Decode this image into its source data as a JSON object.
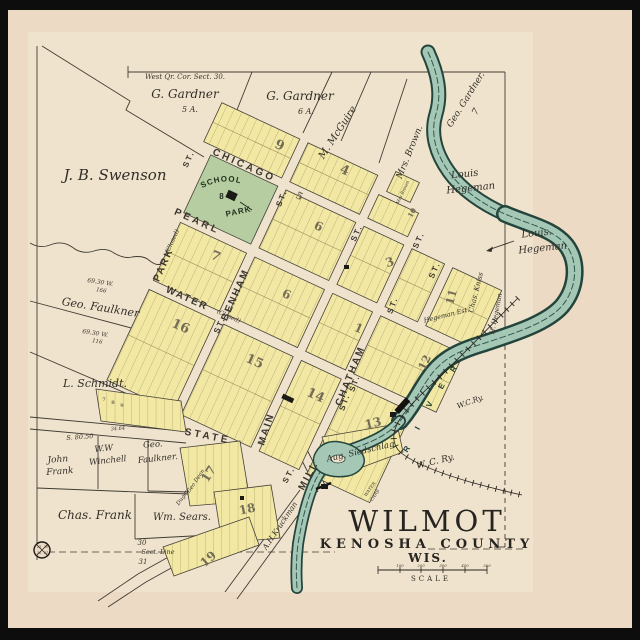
{
  "map_title": {
    "city": "WILMOT",
    "county": "KENOSHA  COUNTY",
    "state": "WIS.",
    "scale_label": "SCALE"
  },
  "park": {
    "line1": "PUBLIC SCHOOL",
    "line2": "PARK",
    "block_no": "8"
  },
  "streets": [
    {
      "t": "CHICAGO",
      "x": 243,
      "y": 168,
      "r": 24,
      "s": 10,
      "ls": 3
    },
    {
      "t": "PEARL",
      "x": 196,
      "y": 224,
      "r": 24,
      "s": 10,
      "ls": 3
    },
    {
      "t": "WATER",
      "x": 186,
      "y": 301,
      "r": 24,
      "s": 10,
      "ls": 2
    },
    {
      "t": "PARK",
      "x": 166,
      "y": 266,
      "r": -66,
      "s": 10,
      "ls": 2
    },
    {
      "t": "BENHAM",
      "x": 238,
      "y": 296,
      "r": -66,
      "s": 10,
      "ls": 2
    },
    {
      "t": "MAIN",
      "x": 269,
      "y": 430,
      "r": -72,
      "s": 10,
      "ls": 2
    },
    {
      "t": "CHATHAM",
      "x": 353,
      "y": 377,
      "r": -68,
      "s": 10,
      "ls": 2
    },
    {
      "t": "STATE",
      "x": 207,
      "y": 439,
      "r": 11,
      "s": 10,
      "ls": 3
    },
    {
      "t": "MILL",
      "x": 311,
      "y": 477,
      "r": -62,
      "s": 10,
      "ls": 2
    }
  ],
  "street_suffixes": [
    {
      "t": "ST.",
      "x": 191,
      "y": 160,
      "r": -66,
      "s": 8
    },
    {
      "t": "ST.",
      "x": 284,
      "y": 199,
      "r": -68,
      "s": 8
    },
    {
      "t": "ST.",
      "x": 359,
      "y": 234,
      "r": -66,
      "s": 8
    },
    {
      "t": "ST.",
      "x": 421,
      "y": 241,
      "r": -66,
      "s": 8
    },
    {
      "t": "ST.",
      "x": 437,
      "y": 271,
      "r": -66,
      "s": 8
    },
    {
      "t": "ST.",
      "x": 395,
      "y": 306,
      "r": -70,
      "s": 8
    },
    {
      "t": "ST.",
      "x": 222,
      "y": 326,
      "r": -66,
      "s": 8
    },
    {
      "t": "ST.",
      "x": 357,
      "y": 384,
      "r": -70,
      "s": 8
    },
    {
      "t": "ST.",
      "x": 347,
      "y": 403,
      "r": -70,
      "s": 8
    },
    {
      "t": "ST.",
      "x": 291,
      "y": 476,
      "r": -62,
      "s": 8
    }
  ],
  "owners": [
    {
      "t": "J. B. Swenson",
      "x": 115,
      "y": 180,
      "r": 0,
      "s": 15
    },
    {
      "t": "G. Gardner",
      "x": 185,
      "y": 98,
      "r": 0,
      "s": 12
    },
    {
      "t": "5 A.",
      "x": 190,
      "y": 112,
      "r": 0,
      "s": 8
    },
    {
      "t": "G. Gardner",
      "x": 300,
      "y": 100,
      "r": 0,
      "s": 12
    },
    {
      "t": "6 A.",
      "x": 306,
      "y": 114,
      "r": 0,
      "s": 8
    },
    {
      "t": "M. McGuire",
      "x": 340,
      "y": 134,
      "r": -57,
      "s": 10
    },
    {
      "t": "Mrs. Brown.",
      "x": 412,
      "y": 153,
      "r": -68,
      "s": 9
    },
    {
      "t": "Geo. Gardner.",
      "x": 468,
      "y": 101,
      "r": -58,
      "s": 9
    },
    {
      "t": "7",
      "x": 478,
      "y": 113,
      "r": -58,
      "s": 9
    },
    {
      "t": "Louis",
      "x": 465,
      "y": 177,
      "r": -6,
      "s": 10
    },
    {
      "t": "Hegeman",
      "x": 471,
      "y": 191,
      "r": -6,
      "s": 10
    },
    {
      "t": "Louis.",
      "x": 537,
      "y": 236,
      "r": -6,
      "s": 10
    },
    {
      "t": "Hegeman",
      "x": 543,
      "y": 251,
      "r": -6,
      "s": 10
    },
    {
      "t": "Geo. Faulkner",
      "x": 100,
      "y": 311,
      "r": 9,
      "s": 11
    },
    {
      "t": "L. Schmidt.",
      "x": 95,
      "y": 387,
      "r": 0,
      "s": 11
    },
    {
      "t": "John",
      "x": 58,
      "y": 462,
      "r": -4,
      "s": 9
    },
    {
      "t": "Frank",
      "x": 60,
      "y": 474,
      "r": -4,
      "s": 9
    },
    {
      "t": "W.W",
      "x": 104,
      "y": 451,
      "r": -6,
      "s": 8.5
    },
    {
      "t": "Winchell",
      "x": 108,
      "y": 463,
      "r": -6,
      "s": 8.5
    },
    {
      "t": "Geo.",
      "x": 153,
      "y": 447,
      "r": -4,
      "s": 8.5
    },
    {
      "t": "Faulkner.",
      "x": 158,
      "y": 461,
      "r": -6,
      "s": 8.5
    },
    {
      "t": "Chas. Frank",
      "x": 95,
      "y": 519,
      "r": 0,
      "s": 12
    },
    {
      "t": "Wm. Sears.",
      "x": 182,
      "y": 520,
      "r": 0,
      "s": 10
    },
    {
      "t": "Chas. Kniss",
      "x": 478,
      "y": 293,
      "r": -76,
      "s": 7
    },
    {
      "t": "H. Hegeman",
      "x": 498,
      "y": 314,
      "r": -79,
      "s": 6.5
    },
    {
      "t": "Hegeman Est.",
      "x": 447,
      "y": 317,
      "r": -14,
      "s": 6.5
    },
    {
      "t": "Aug. Siedschlag",
      "x": 361,
      "y": 454,
      "r": -13,
      "s": 8.5
    },
    {
      "t": "A.H.Kruckman",
      "x": 282,
      "y": 527,
      "r": -56,
      "s": 7.5
    },
    {
      "t": "Geo Dean",
      "x": 197,
      "y": 482,
      "r": -56,
      "s": 5.5
    },
    {
      "t": "Dugan",
      "x": 184,
      "y": 498,
      "r": -56,
      "s": 5.5
    },
    {
      "t": "Mrs Brown",
      "x": 404,
      "y": 193,
      "r": -65,
      "s": 4.5
    }
  ],
  "blocks": [
    {
      "t": "9",
      "x": 278,
      "y": 149,
      "r": 24,
      "s": 13
    },
    {
      "t": "4",
      "x": 343,
      "y": 174,
      "r": 24,
      "s": 13
    },
    {
      "t": "10",
      "x": 414,
      "y": 214,
      "r": -60,
      "s": 7
    },
    {
      "t": "5",
      "x": 298,
      "y": 199,
      "r": 24,
      "s": 10
    },
    {
      "t": "6",
      "x": 317,
      "y": 230,
      "r": 24,
      "s": 12
    },
    {
      "t": "7",
      "x": 214,
      "y": 260,
      "r": 24,
      "s": 13
    },
    {
      "t": "6",
      "x": 285,
      "y": 298,
      "r": 24,
      "s": 12
    },
    {
      "t": "3",
      "x": 391,
      "y": 266,
      "r": -18,
      "s": 12
    },
    {
      "t": "1",
      "x": 357,
      "y": 332,
      "r": 24,
      "s": 12
    },
    {
      "t": "11",
      "x": 455,
      "y": 298,
      "r": -75,
      "s": 11
    },
    {
      "t": "12",
      "x": 428,
      "y": 364,
      "r": -65,
      "s": 11
    },
    {
      "t": "16",
      "x": 179,
      "y": 330,
      "r": 24,
      "s": 13
    },
    {
      "t": "15",
      "x": 253,
      "y": 365,
      "r": 24,
      "s": 13
    },
    {
      "t": "14",
      "x": 314,
      "y": 399,
      "r": 24,
      "s": 13
    },
    {
      "t": "13",
      "x": 374,
      "y": 427,
      "r": -14,
      "s": 12
    },
    {
      "t": "17",
      "x": 212,
      "y": 476,
      "r": -58,
      "s": 12
    },
    {
      "t": "18",
      "x": 248,
      "y": 513,
      "r": -12,
      "s": 12
    },
    {
      "t": "19",
      "x": 211,
      "y": 562,
      "r": -42,
      "s": 12
    },
    {
      "t": "7",
      "x": 104,
      "y": 401,
      "r": 0,
      "s": 5
    },
    {
      "t": "8",
      "x": 113,
      "y": 404,
      "r": 0,
      "s": 5
    },
    {
      "t": "9",
      "x": 122,
      "y": 407,
      "r": 0,
      "s": 5
    }
  ],
  "annotations": [
    {
      "t": "West Qr. Cor. Sect. 30.",
      "x": 185,
      "y": 79,
      "r": 0,
      "s": 7
    },
    {
      "t": "69.30 W.",
      "x": 100,
      "y": 284,
      "r": 9,
      "s": 6
    },
    {
      "t": "166",
      "x": 101,
      "y": 292,
      "r": 9,
      "s": 5.5
    },
    {
      "t": "69.30 W.",
      "x": 95,
      "y": 335,
      "r": 9,
      "s": 6
    },
    {
      "t": "116",
      "x": 97,
      "y": 343,
      "r": 9,
      "s": 5.5
    },
    {
      "t": "34.64",
      "x": 118,
      "y": 430,
      "r": -4,
      "s": 5
    },
    {
      "t": "S. 80.50",
      "x": 80,
      "y": 439,
      "r": -4,
      "s": 6.5
    },
    {
      "t": "30",
      "x": 142,
      "y": 545,
      "r": 0,
      "s": 7
    },
    {
      "t": "Sect. Line",
      "x": 158,
      "y": 554,
      "r": 0,
      "s": 6.5
    },
    {
      "t": "31",
      "x": 143,
      "y": 564,
      "r": 0,
      "s": 7
    },
    {
      "t": "(Closed)",
      "x": 174,
      "y": 242,
      "r": -66,
      "s": 6
    },
    {
      "t": "(Closed)",
      "x": 228,
      "y": 318,
      "r": 24,
      "s": 6
    },
    {
      "t": "WATER",
      "x": 371,
      "y": 490,
      "r": -55,
      "s": 4.4
    },
    {
      "t": "CARS",
      "x": 376,
      "y": 496,
      "r": -55,
      "s": 4.4
    },
    {
      "t": "100",
      "x": 400,
      "y": 567,
      "r": 0,
      "s": 3.8
    },
    {
      "t": "200",
      "x": 421,
      "y": 567,
      "r": 0,
      "s": 3.8
    },
    {
      "t": "300",
      "x": 443,
      "y": 567,
      "r": 0,
      "s": 3.8
    },
    {
      "t": "400",
      "x": 465,
      "y": 567,
      "r": 0,
      "s": 3.8
    },
    {
      "t": "500",
      "x": 487,
      "y": 567,
      "r": 0,
      "s": 3.8
    },
    {
      "t": "25",
      "x": 39,
      "y": 548,
      "r": 0,
      "s": 3.4
    },
    {
      "t": "30",
      "x": 46,
      "y": 548,
      "r": 0,
      "s": 3.4
    },
    {
      "t": "36",
      "x": 39,
      "y": 554,
      "r": 0,
      "s": 3.4
    },
    {
      "t": "31",
      "x": 46,
      "y": 554,
      "r": 0,
      "s": 3.4
    }
  ],
  "river_letters": [
    {
      "t": "R",
      "x": 409,
      "y": 450,
      "r": -58,
      "s": 8
    },
    {
      "t": "I",
      "x": 420,
      "y": 429,
      "r": -62,
      "s": 8
    },
    {
      "t": "V",
      "x": 432,
      "y": 405,
      "r": -66,
      "s": 8
    },
    {
      "t": "E",
      "x": 444,
      "y": 387,
      "r": -62,
      "s": 8
    },
    {
      "t": "R",
      "x": 456,
      "y": 370,
      "r": -58,
      "s": 8
    }
  ],
  "railroad_labels": [
    {
      "t": "W.C.Ry.",
      "x": 471,
      "y": 404,
      "r": -20,
      "s": 7.5
    },
    {
      "t": "W.  C.  Ry.",
      "x": 436,
      "y": 464,
      "r": -14,
      "s": 9
    }
  ],
  "colors": {
    "frame": "#0d0d0d",
    "paper": "#ecdac4",
    "map_paper": "#f0e3cd",
    "block_fill": "#f2e8a4",
    "park_fill": "#b5cda1",
    "river_fill": "#a4c7b6",
    "river_edge": "#24453c",
    "ink": "#33302a"
  }
}
